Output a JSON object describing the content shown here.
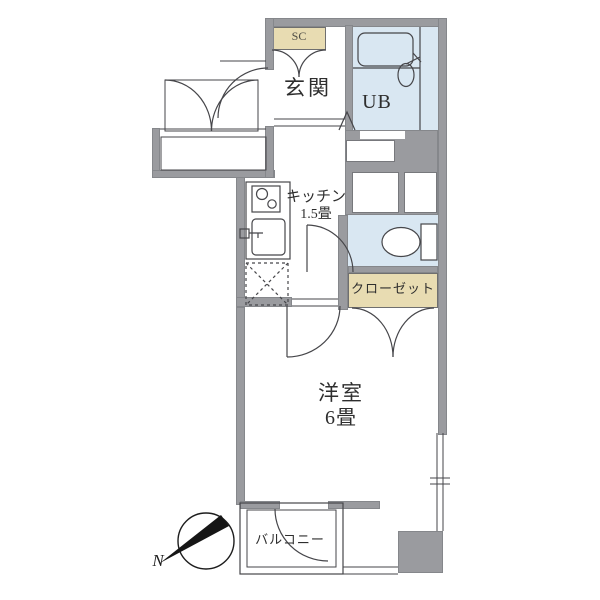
{
  "plan": {
    "labels": {
      "shoe_cabinet": "SC",
      "entrance": "玄関",
      "unit_bath": "UB",
      "kitchen_name": "キッチン",
      "kitchen_size": "1.5畳",
      "closet": "クローゼット",
      "western_room_name": "洋室",
      "western_room_size": "6畳",
      "balcony": "バルコニー"
    },
    "compass": {
      "north_label": "N"
    },
    "colors": {
      "wall": "#9a9b9f",
      "wet_area_fill": "#d9e7f2",
      "storage_fill": "#e8dcb2",
      "line": "#46464a"
    }
  }
}
